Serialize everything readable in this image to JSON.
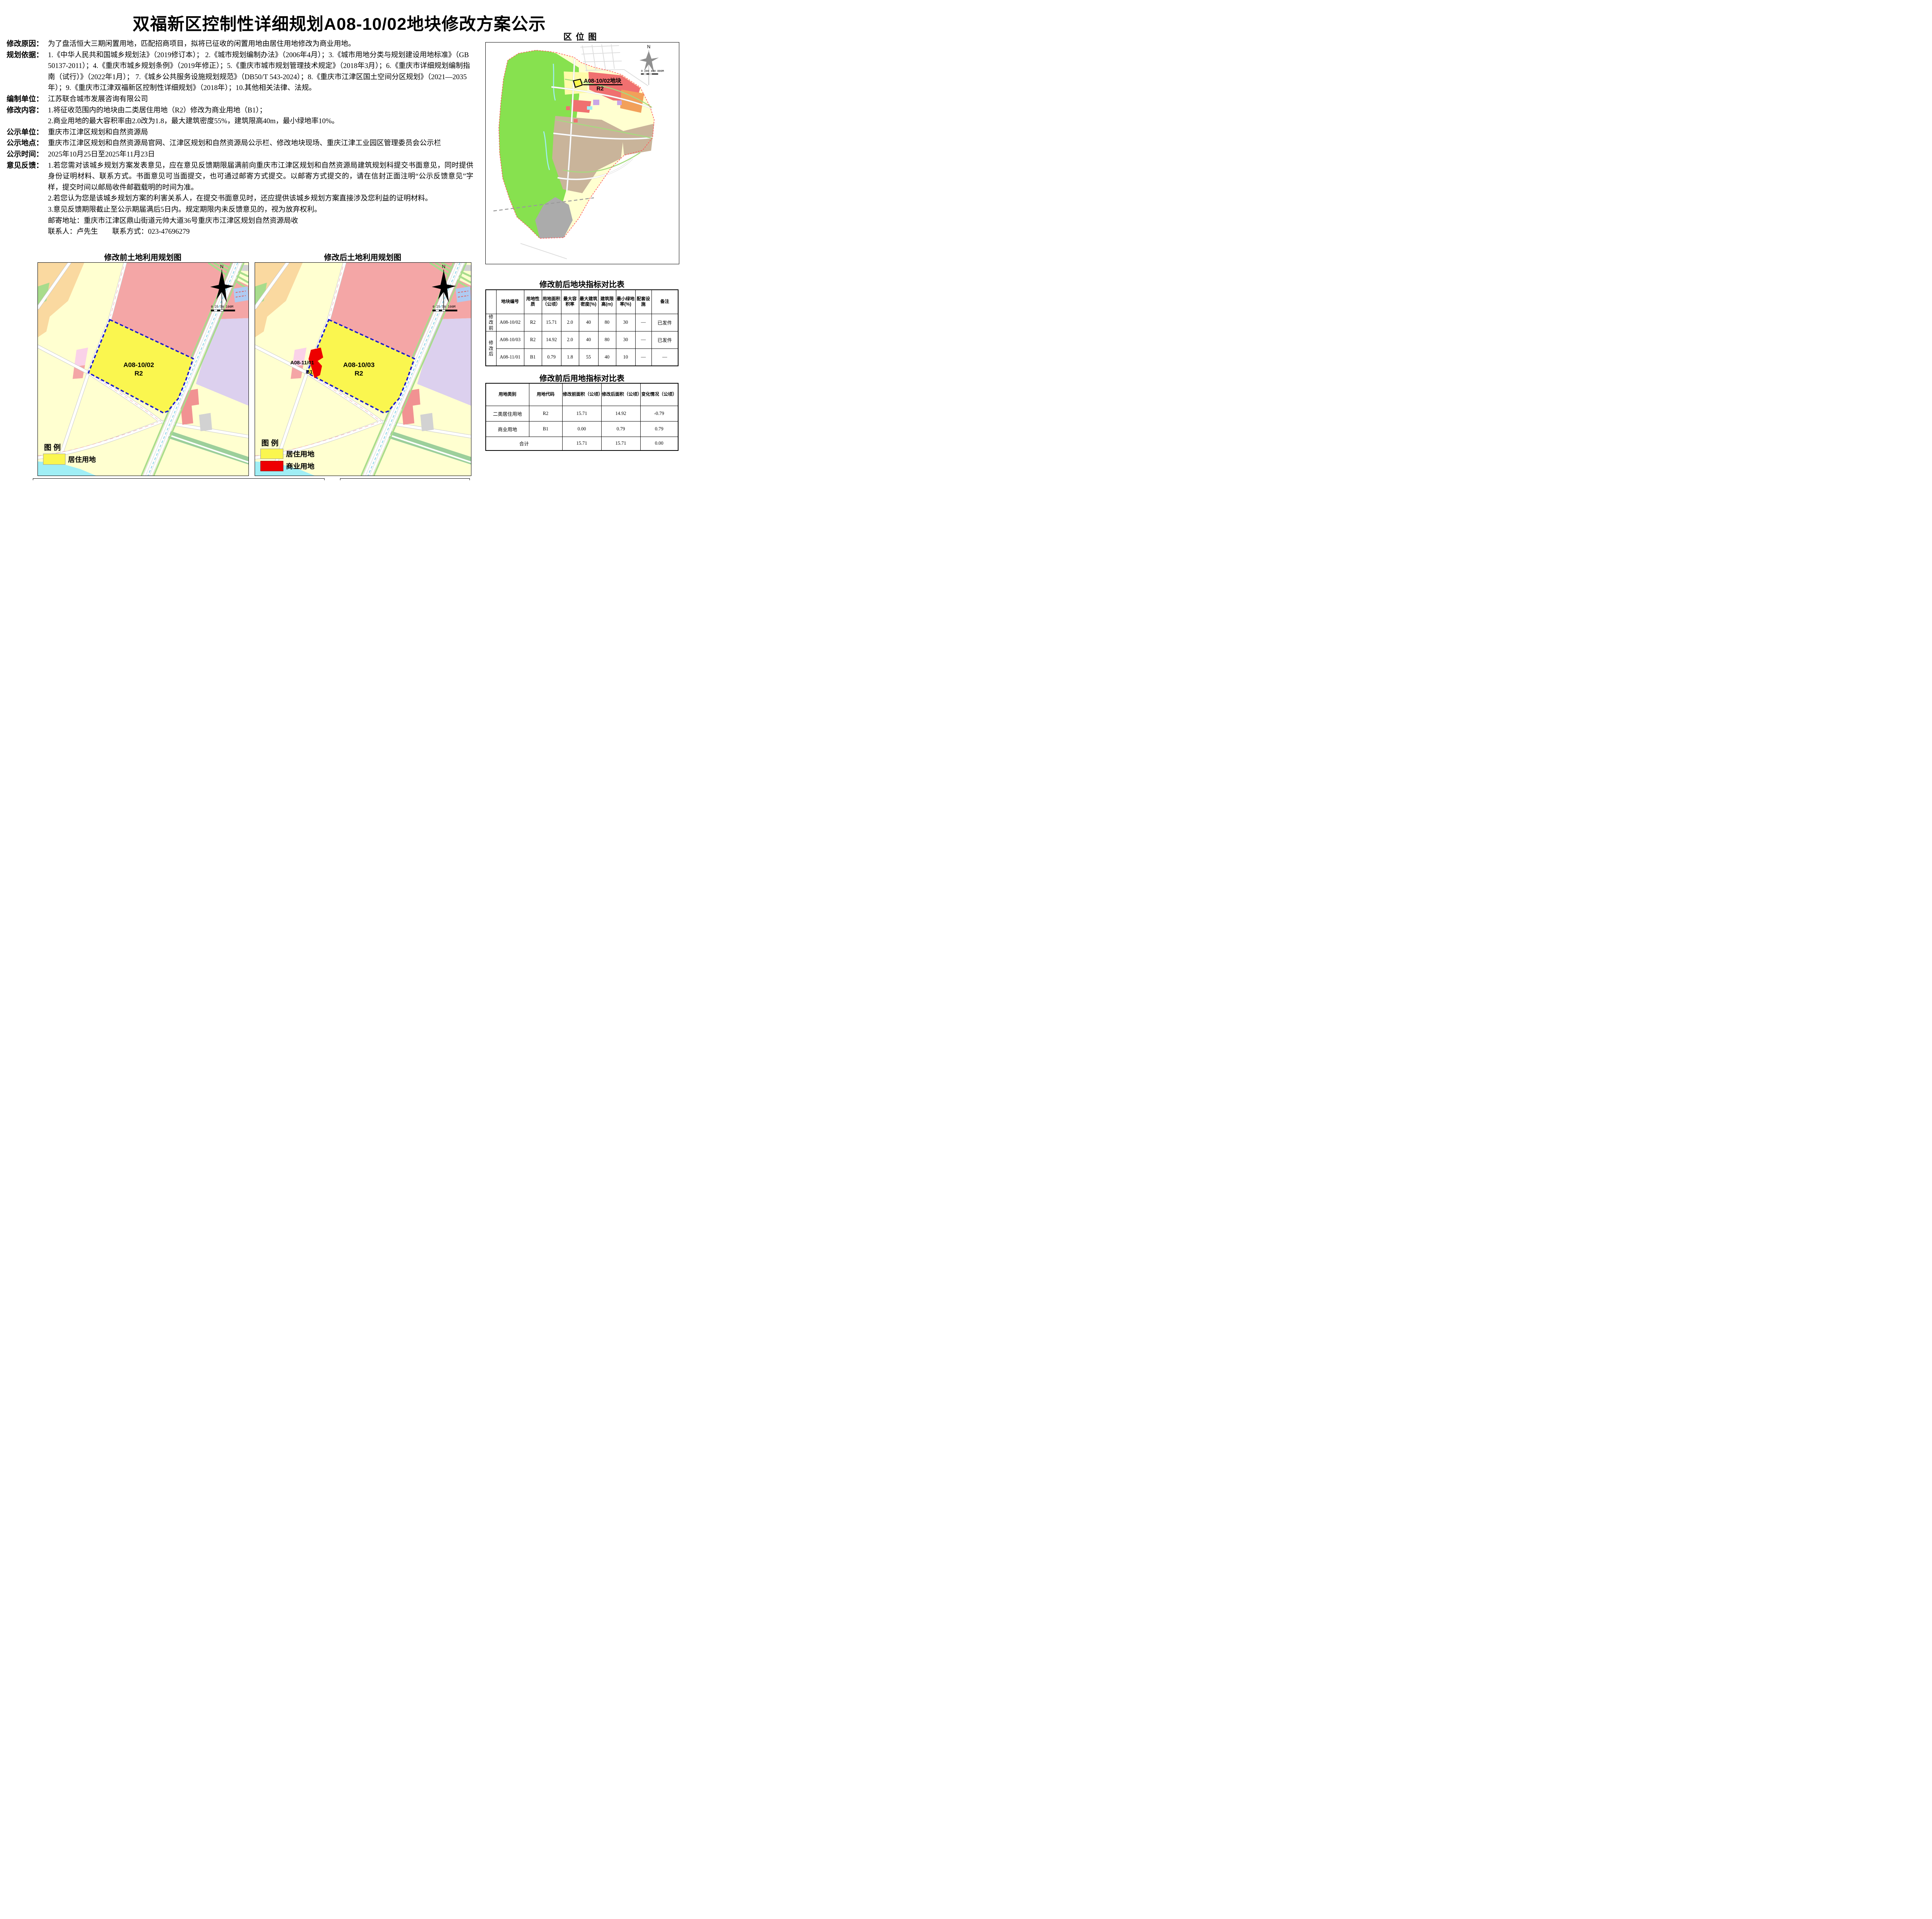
{
  "page": {
    "title": "双福新区控制性详细规划A08-10/02地块修改方案公示"
  },
  "info": {
    "rows": [
      {
        "label": "修改原因：",
        "paragraphs": [
          "为了盘活恒大三期闲置用地，匹配招商项目，拟将已征收的闲置用地由居住用地修改为商业用地。"
        ]
      },
      {
        "label": "规划依据：",
        "paragraphs": [
          "1.《中华人民共和国城乡规划法》（2019修订本）； 2.《城市规划编制办法》（2006年4月）；3.《城市用地分类与规划建设用地标准》（GB 50137-2011）；4.《重庆市城乡规划条例》（2019年修正）；5.《重庆市城市规划管理技术规定》（2018年3月）；6.《重庆市详细规划编制指南（试行）》（2022年1月）； 7.《城乡公共服务设施规划规范》（DB50/T 543-2024）；8.《重庆市江津区国土空间分区规划》（2021—2035年）；9.《重庆市江津双福新区控制性详细规划》（2018年）；10.其他相关法律、法规。"
        ]
      },
      {
        "label": "编制单位：",
        "paragraphs": [
          "江苏联合城市发展咨询有限公司"
        ]
      },
      {
        "label": "修改内容：",
        "paragraphs": [
          "1.将征收范围内的地块由二类居住用地（R2）修改为商业用地（B1）；",
          "2.商业用地的最大容积率由2.0改为1.8，最大建筑密度55%，建筑限高40m，最小绿地率10%。"
        ]
      },
      {
        "label": "公示单位：",
        "paragraphs": [
          "重庆市江津区规划和自然资源局"
        ]
      },
      {
        "label": "公示地点：",
        "paragraphs": [
          "重庆市江津区规划和自然资源局官网、江津区规划和自然资源局公示栏、修改地块现场、重庆江津工业园区管理委员会公示栏"
        ]
      },
      {
        "label": "公示时间：",
        "paragraphs": [
          "2025年10月25日至2025年11月23日"
        ]
      },
      {
        "label": "意见反馈：",
        "paragraphs": [
          "1.若您需对该城乡规划方案发表意见，应在意见反馈期限届满前向重庆市江津区规划和自然资源局建筑规划科提交书面意见，同时提供身份证明材料、联系方式。书面意见可当面提交，也可通过邮寄方式提交。以邮寄方式提交的，请在信封正面注明“公示反馈意见”字样，提交时间以邮局收件邮戳载明的时间为准。",
          "2.若您认为您是该城乡规划方案的利害关系人，在提交书面意见时，还应提供该城乡规划方案直接涉及您利益的证明材料。",
          "3.意见反馈期限截止至公示期届满后5日内。规定期限内未反馈意见的，视为放弃权利。",
          "邮寄地址：重庆市江津区鼎山街道元帅大道36号重庆市江津区规划自然资源局收",
          "联系人：卢先生　　联系方式：023-47696279"
        ]
      }
    ]
  },
  "location_map": {
    "title": "区位图",
    "plot_label": "A08-10/02地块",
    "plot_code": "R2",
    "north": "N",
    "scale_text": "0  200 400    800M"
  },
  "maps": {
    "before": {
      "title": "修改前土地利用规划图",
      "plot_id": "A08-10/02",
      "plot_code": "R2"
    },
    "after": {
      "title": "修改后土地利用规划图",
      "plot_id": "A08-10/03",
      "plot_code": "R2",
      "plot2_id": "A08-11/01",
      "plot2_code": "B1"
    },
    "north": "N",
    "scale_text": "0  25 50   100M",
    "legend_title": "图 例",
    "legend_residential": "居住用地",
    "legend_commercial": "商业用地"
  },
  "table1": {
    "title": "修改前后地块指标对比表",
    "headers": [
      "",
      "地块编号",
      "用地性质",
      "用地面积（公顷）",
      "最大容积率",
      "最大建筑密度(%)",
      "建筑限高(m)",
      "最小绿地率(%)",
      "配套设施",
      "备注"
    ],
    "rows": [
      {
        "group": "修改前",
        "cells": [
          "A08-10/02",
          "R2",
          "15.71",
          "2.0",
          "40",
          "80",
          "30",
          "—",
          "已发件"
        ]
      },
      {
        "group": "修改后",
        "cells": [
          "A08-10/03",
          "R2",
          "14.92",
          "2.0",
          "40",
          "80",
          "30",
          "—",
          "已发件"
        ]
      },
      {
        "group": "",
        "cells": [
          "A08-11/01",
          "B1",
          "0.79",
          "1.8",
          "55",
          "40",
          "10",
          "—",
          "—"
        ]
      }
    ]
  },
  "table2": {
    "title": "修改前后用地指标对比表",
    "headers": [
      "用地类别",
      "用地代码",
      "修改前面积（公顷）",
      "修改后面积（公顷）",
      "变化情况（公顷）"
    ],
    "rows": [
      [
        "二类居住用地",
        "R2",
        "15.71",
        "14.92",
        "-0.79"
      ],
      [
        "商业用地",
        "B1",
        "0.00",
        "0.79",
        "0.79"
      ]
    ],
    "total_label": "合计",
    "total": [
      "15.71",
      "15.71",
      "0.00"
    ]
  },
  "colors": {
    "residential": "#FAF64F",
    "commercial": "#EE0000",
    "boundary_blue": "#1A1ACC",
    "boundary_red": "#FF5A5A",
    "cream": "#FFFFD0",
    "orange": "#FAD9A0",
    "pink": "#F4A6A6",
    "pink2": "#F19292",
    "pinklight": "#FAD2E8",
    "lavender": "#DCD0EE",
    "green_strip": "#A8DC8C",
    "green2": "#9CCF9B",
    "water": "#A0EEF5",
    "pond": "#AFCBF2",
    "gray": "#D2D2D2",
    "locgreen": "#87E14F",
    "locred": "#F07070",
    "locorange": "#F2A05A",
    "loctan": "#C9B49A",
    "locyellow": "#FFFCA8",
    "locpurple": "#C9A6E6",
    "locgray": "#ABABAB"
  }
}
